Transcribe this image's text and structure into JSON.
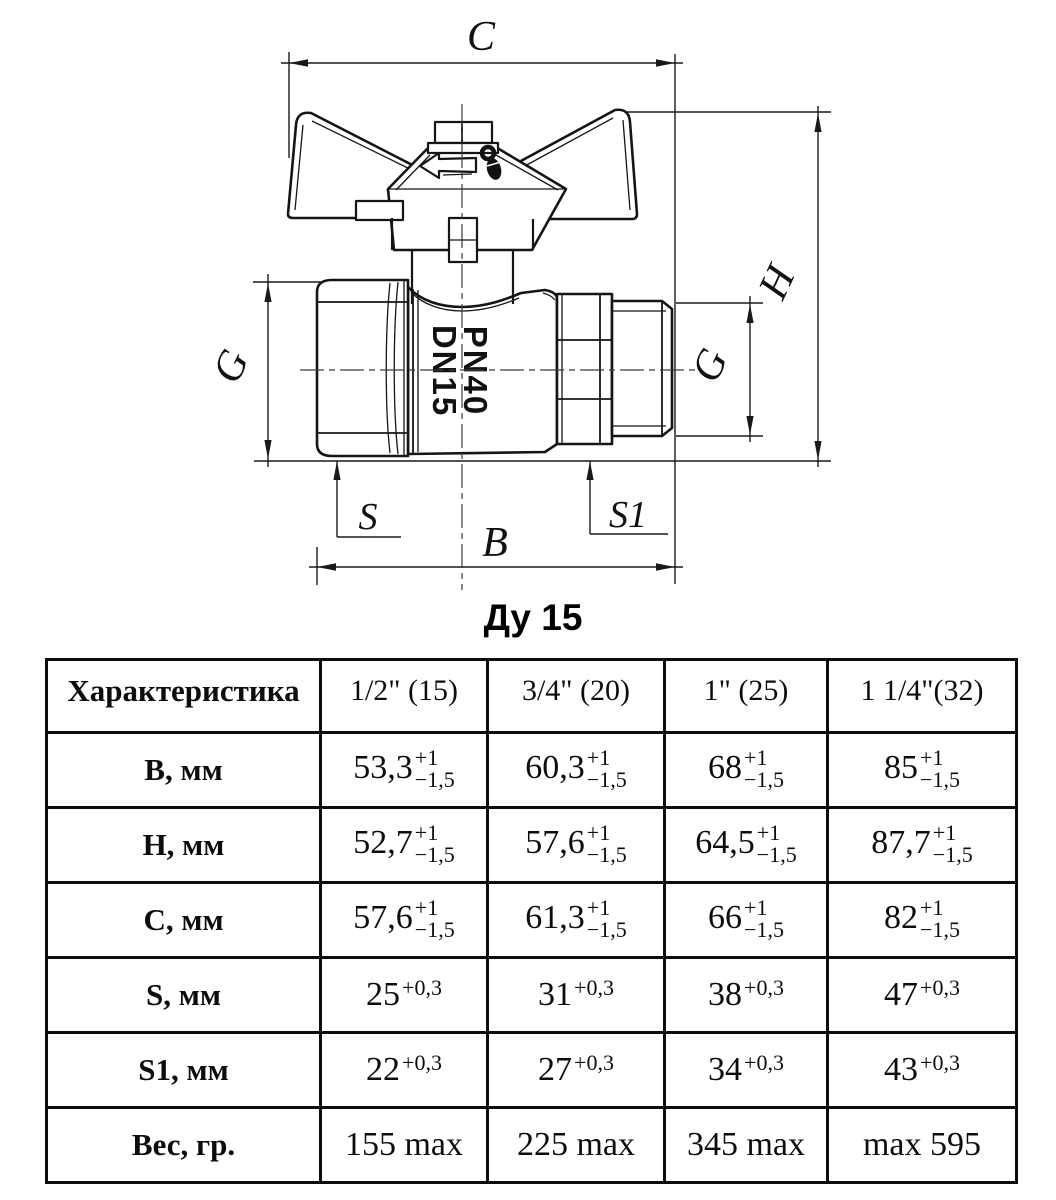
{
  "drawing": {
    "caption": "Ду 15",
    "marking": {
      "line1": "PN40",
      "line2": "DN15"
    },
    "dims": {
      "c": "C",
      "h": "H",
      "g_left": "G",
      "g_right": "G",
      "s": "S",
      "s1": "S1",
      "b": "B"
    }
  },
  "table": {
    "columns": [
      "Характеристика",
      "1/2\" (15)",
      "3/4\" (20)",
      "1\" (25)",
      "1 1/4\"(32)"
    ],
    "rows": [
      {
        "label": "B, мм",
        "cells": [
          {
            "b": "53,3",
            "sup": "+1",
            "sub": "−1,5"
          },
          {
            "b": "60,3",
            "sup": "+1",
            "sub": "−1,5"
          },
          {
            "b": "68",
            "sup": "+1",
            "sub": "−1,5"
          },
          {
            "b": "85",
            "sup": "+1",
            "sub": "−1,5"
          }
        ]
      },
      {
        "label": "H, мм",
        "cells": [
          {
            "b": "52,7",
            "sup": "+1",
            "sub": "−1,5"
          },
          {
            "b": "57,6",
            "sup": "+1",
            "sub": "−1,5"
          },
          {
            "b": "64,5",
            "sup": "+1",
            "sub": "−1,5"
          },
          {
            "b": "87,7",
            "sup": "+1",
            "sub": "−1,5"
          }
        ]
      },
      {
        "label": "C, мм",
        "cells": [
          {
            "b": "57,6",
            "sup": "+1",
            "sub": "−1,5"
          },
          {
            "b": "61,3",
            "sup": "+1",
            "sub": "−1,5"
          },
          {
            "b": "66",
            "sup": "+1",
            "sub": "−1,5"
          },
          {
            "b": "82",
            "sup": "+1",
            "sub": "−1,5"
          }
        ]
      },
      {
        "label": "S, мм",
        "cells": [
          {
            "b": "25",
            "sup": "+0,3"
          },
          {
            "b": "31",
            "sup": "+0,3"
          },
          {
            "b": "38",
            "sup": "+0,3"
          },
          {
            "b": "47",
            "sup": "+0,3"
          }
        ]
      },
      {
        "label": "S1, мм",
        "cells": [
          {
            "b": "22",
            "sup": "+0,3"
          },
          {
            "b": "27",
            "sup": "+0,3"
          },
          {
            "b": "34",
            "sup": "+0,3"
          },
          {
            "b": "43",
            "sup": "+0,3"
          }
        ]
      },
      {
        "label": "Вес, гр.",
        "cells": [
          {
            "b": "155 max"
          },
          {
            "b": "225 max"
          },
          {
            "b": "345 max"
          },
          {
            "b": "max 595"
          }
        ]
      }
    ]
  }
}
